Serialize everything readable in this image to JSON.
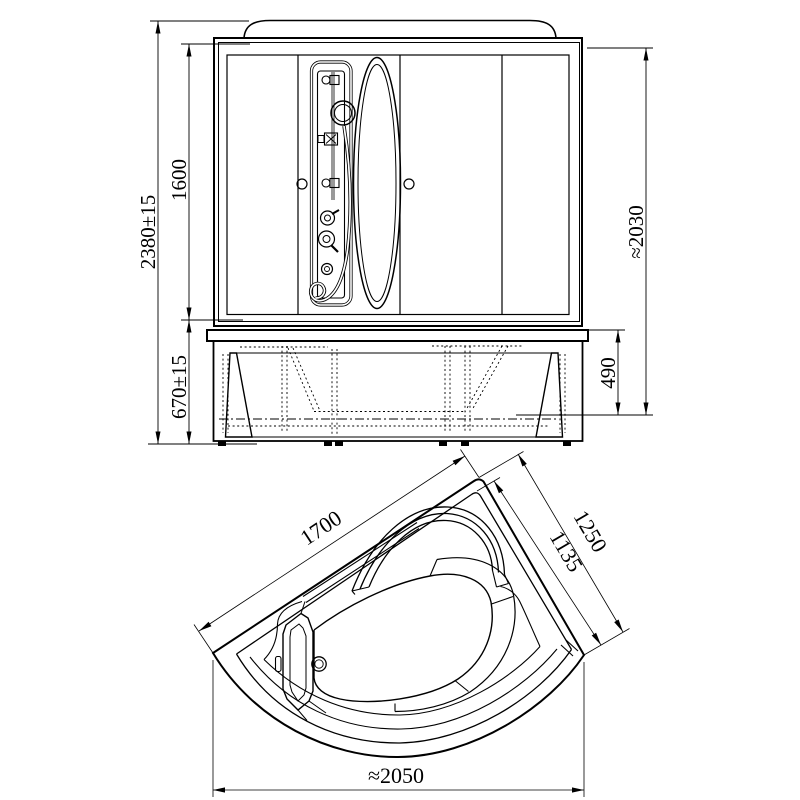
{
  "drawing": {
    "type": "technical-drawing",
    "subject": "corner shower cabin with bathtub - front elevation and plan view",
    "ink_color": "#000000",
    "background_color": "#ffffff",
    "front_view": {
      "dim_total_height": "2380±15",
      "dim_glass_section_height": "1600",
      "dim_bath_height": "670±15",
      "dim_inner_height": "≈2030",
      "dim_bath_depth": "490"
    },
    "plan_view": {
      "dim_left_edge": "1700",
      "dim_right_edge": "1250",
      "dim_right_inner": "1135",
      "dim_overall_width": "≈2050"
    }
  }
}
